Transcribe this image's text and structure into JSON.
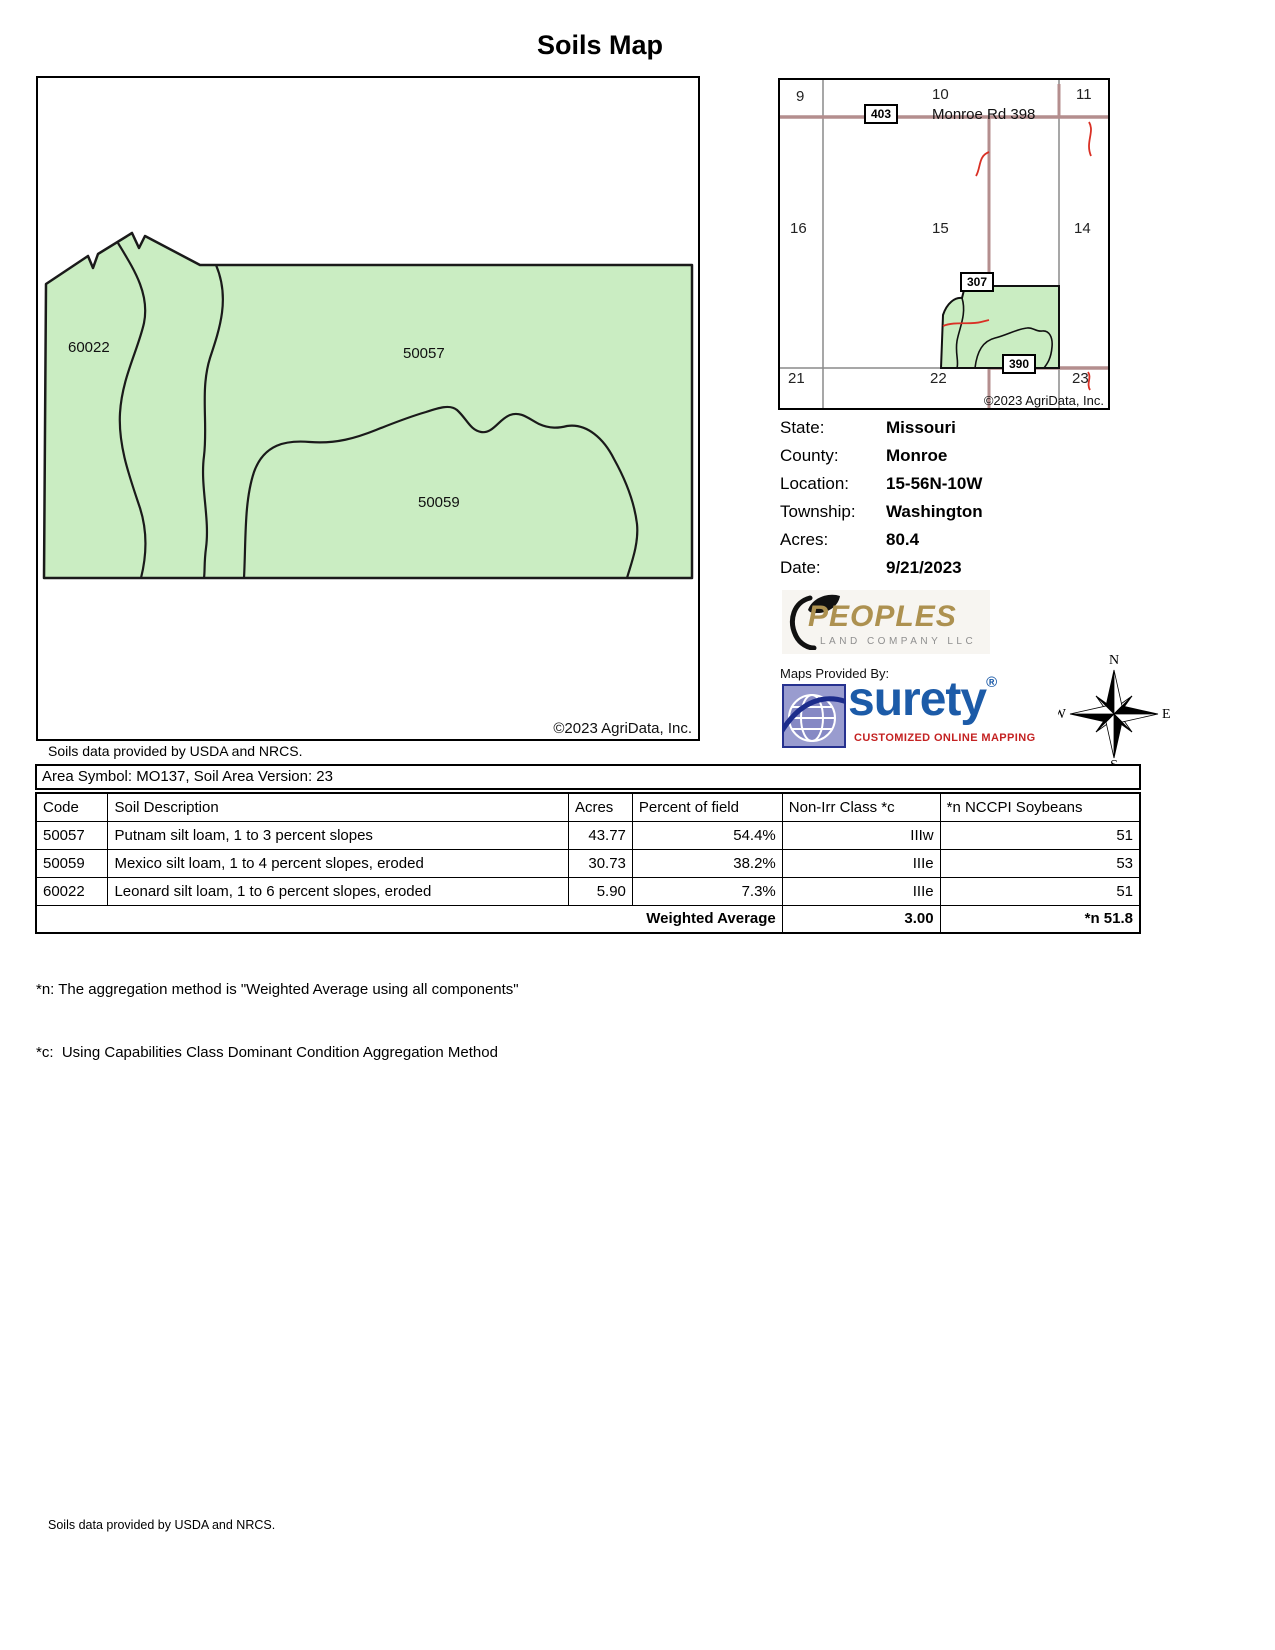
{
  "title": "Soils Map",
  "map": {
    "labels": [
      "60022",
      "50057",
      "50059"
    ],
    "copyright": "©2023 AgriData, Inc."
  },
  "soils_note": "Soils data provided by USDA and NRCS.",
  "locator": {
    "sections": [
      "9",
      "10",
      "11",
      "16",
      "15",
      "14",
      "21",
      "22",
      "23"
    ],
    "badges": [
      "403",
      "307",
      "390"
    ],
    "road_label": "Monroe Rd 398",
    "copyright": "©2023 AgriData, Inc."
  },
  "info": {
    "rows": [
      {
        "label": "State:",
        "value": "Missouri"
      },
      {
        "label": "County:",
        "value": "Monroe"
      },
      {
        "label": "Location:",
        "value": "15-56N-10W"
      },
      {
        "label": "Township:",
        "value": "Washington"
      },
      {
        "label": "Acres:",
        "value": "80.4"
      },
      {
        "label": "Date:",
        "value": "9/21/2023"
      }
    ]
  },
  "branding": {
    "peoples_name": "PEOPLES",
    "peoples_sub": "LAND COMPANY LLC",
    "maps_provided_by": "Maps Provided By:",
    "surety_name": "surety",
    "surety_reg": "®",
    "surety_tagline": "CUSTOMIZED ONLINE MAPPING",
    "surety_copyright": "© AgriData, Inc. 2023",
    "surety_url": "www.AgriDataInc.com"
  },
  "compass": {
    "n": "N",
    "e": "E",
    "s": "S",
    "w": "W"
  },
  "table": {
    "area_header": "Area Symbol: MO137, Soil Area Version: 23",
    "columns": [
      "Code",
      "Soil Description",
      "Acres",
      "Percent of field",
      "Non-Irr Class *c",
      "*n NCCPI Soybeans"
    ],
    "rows": [
      {
        "code": "50057",
        "description": "Putnam silt loam, 1 to 3 percent slopes",
        "acres": "43.77",
        "percent": "54.4%",
        "nonirr": "IIIw",
        "nccpi": "51"
      },
      {
        "code": "50059",
        "description": "Mexico silt loam, 1 to 4 percent slopes, eroded",
        "acres": "30.73",
        "percent": "38.2%",
        "nonirr": "IIIe",
        "nccpi": "53"
      },
      {
        "code": "60022",
        "description": "Leonard silt loam, 1 to 6 percent slopes, eroded",
        "acres": "5.90",
        "percent": "7.3%",
        "nonirr": "IIIe",
        "nccpi": "51"
      }
    ],
    "weighted": {
      "label": "Weighted Average",
      "nonirr": "3.00",
      "nccpi": "*n 51.8"
    }
  },
  "footnotes": [
    "*n: The aggregation method is \"Weighted Average using all components\"",
    "*c:  Using Capabilities Class Dominant Condition Aggregation Method"
  ],
  "footer_note": "Soils data provided by USDA and NRCS.",
  "colors": {
    "field_green": "#CAEDC2",
    "road_brown": "#B48E8E",
    "creek_red": "#D93025",
    "grid_gray": "#8A8A8A",
    "surety_blue": "#1C5BA8",
    "surety_tag_red": "#C42222",
    "peoples_gold": "#AD9150"
  }
}
